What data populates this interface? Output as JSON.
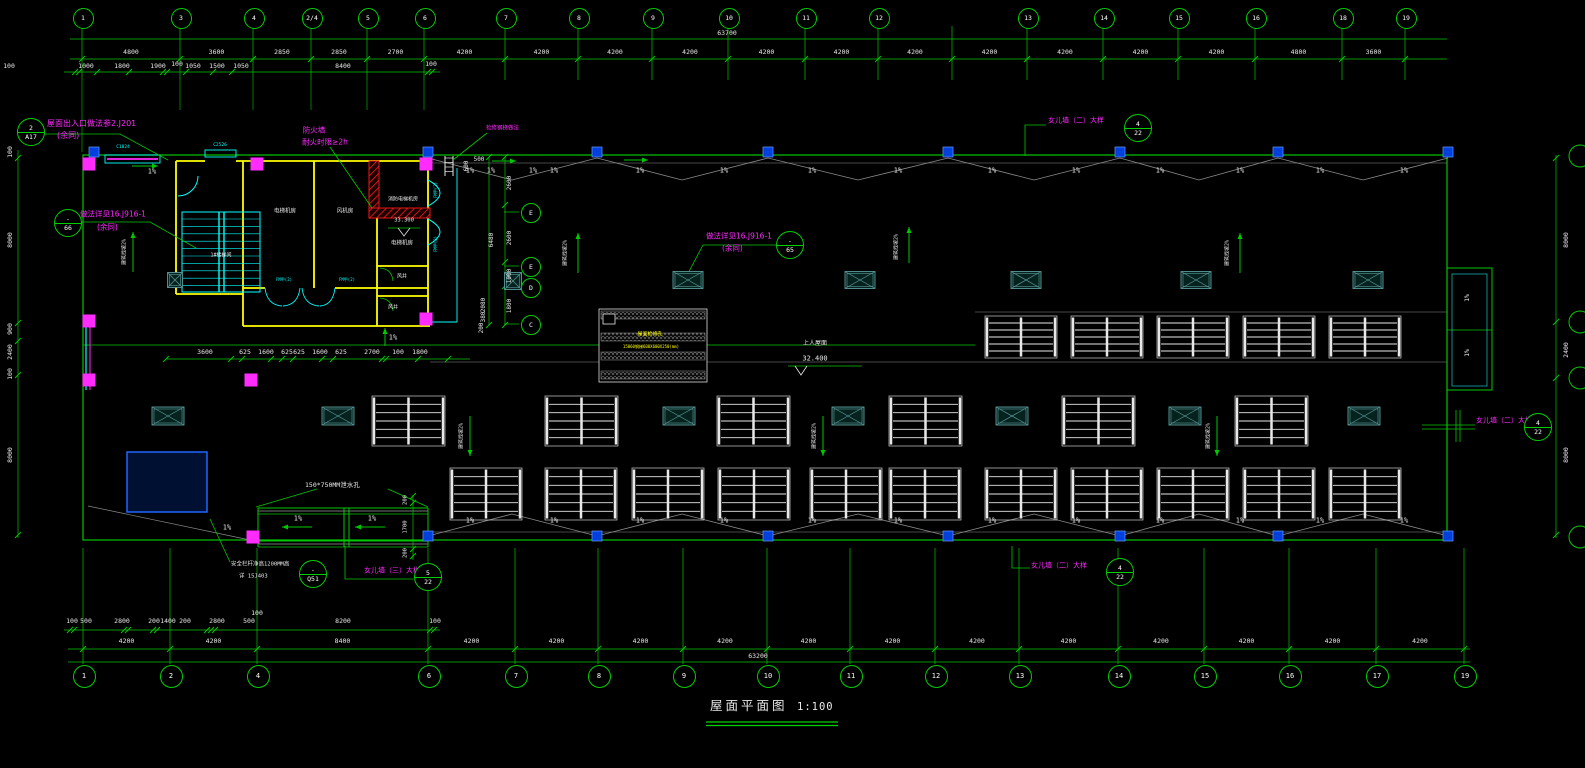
{
  "drawing": {
    "title": "屋面平面图",
    "scale": "1:100"
  },
  "grid": {
    "top_bubbles": [
      "1",
      "3",
      "4",
      "2/4",
      "5",
      "6",
      "7",
      "8",
      "9",
      "10",
      "11",
      "12",
      "13",
      "14",
      "15",
      "16",
      "18",
      "19"
    ],
    "top_spans": [
      "4800",
      "3600",
      "2850",
      "2850",
      "2700",
      "4200",
      "4200",
      "4200",
      "4200",
      "4200",
      "4200",
      "4200",
      "4200",
      "4200",
      "4200",
      "4200",
      "4800",
      "3600"
    ],
    "top_total": "63700",
    "top_sub": [
      "100",
      "1000",
      "1800",
      "1900",
      "100",
      "1050",
      "1500",
      "1050",
      "8400",
      "100"
    ],
    "bottom_bubbles": [
      "1",
      "2",
      "4",
      "6",
      "7",
      "8",
      "9",
      "10",
      "11",
      "12",
      "13",
      "14",
      "15",
      "16",
      "17",
      "19"
    ],
    "bottom_spans": [
      "4200",
      "4200",
      "8400",
      "4200",
      "4200",
      "4200",
      "4200",
      "4200",
      "4200",
      "4200",
      "4200",
      "4200",
      "4200",
      "4200",
      "4200"
    ],
    "bottom_total": "63200",
    "bottom_sub": [
      "100",
      "500",
      "2800",
      "200",
      "1400",
      "200",
      "2800",
      "500",
      "100",
      "8200",
      "100"
    ],
    "left_chain": [
      "100",
      "8000",
      "900",
      "2400",
      "100",
      "8000"
    ],
    "right_chain": [
      "8000",
      "2400",
      "8000"
    ],
    "row_bubbles": [
      "E",
      "E",
      "D",
      "C"
    ],
    "block_chain": [
      "500",
      "2600",
      "2600",
      "1000",
      "1800",
      "6480",
      "2080",
      "380",
      "200",
      "600"
    ],
    "mid_chain": [
      "3600",
      "625",
      "1600",
      "625",
      "625",
      "1600",
      "625",
      "2700",
      "100",
      "1800"
    ],
    "canopy_chain": [
      "200",
      "1700",
      "200"
    ]
  },
  "annotations": {
    "roof_entry": {
      "line1": "屋面出入口做法参2.J201",
      "line2": "(余同)",
      "bubble_top": "2",
      "bubble_bottom": "A17"
    },
    "detail66": {
      "line1": "做法详见16.J916-1",
      "line2": "(余同)",
      "bubble_top": "-",
      "bubble_bottom": "66"
    },
    "detail65": {
      "line1": "做法详见16.J916-1",
      "line2": "(余同)",
      "bubble_top": "-",
      "bubble_bottom": "65"
    },
    "firewall": {
      "line1": "防火墙",
      "line2": "耐火时限≥2h"
    },
    "ladder": "检修钢梯做法",
    "parapet2": {
      "label": "女儿墙（二）大样",
      "num": "4",
      "den": "22"
    },
    "parapet3": {
      "label": "女儿墙（三）大样",
      "num": "5",
      "den": "22"
    },
    "scupper": "150*750MM泄水孔",
    "railing": {
      "line1": "安全栏杆净高1200MM高",
      "line2": "详 15J403",
      "bubble_top": "-",
      "bubble_bottom": "Q51"
    },
    "upper_roof": {
      "label": "上人屋面",
      "level": "32.400"
    },
    "level_333": "33.300",
    "slope_note": "建筑找坡2%",
    "slope_pct": "1%",
    "tank_line1": "屋面检修孔",
    "tank_line2": "15060钢梯600X600X250(mm)"
  },
  "rooms": {
    "stair": "1#楼梯间",
    "elev_mech": "电梯机房",
    "fan": "风机房",
    "fire_elev": "消防电梯机房",
    "elev": "电梯机房",
    "shaft": "风井"
  },
  "tags": {
    "window1": "C1824",
    "window2": "C2526",
    "door": "FM甲(2)"
  }
}
